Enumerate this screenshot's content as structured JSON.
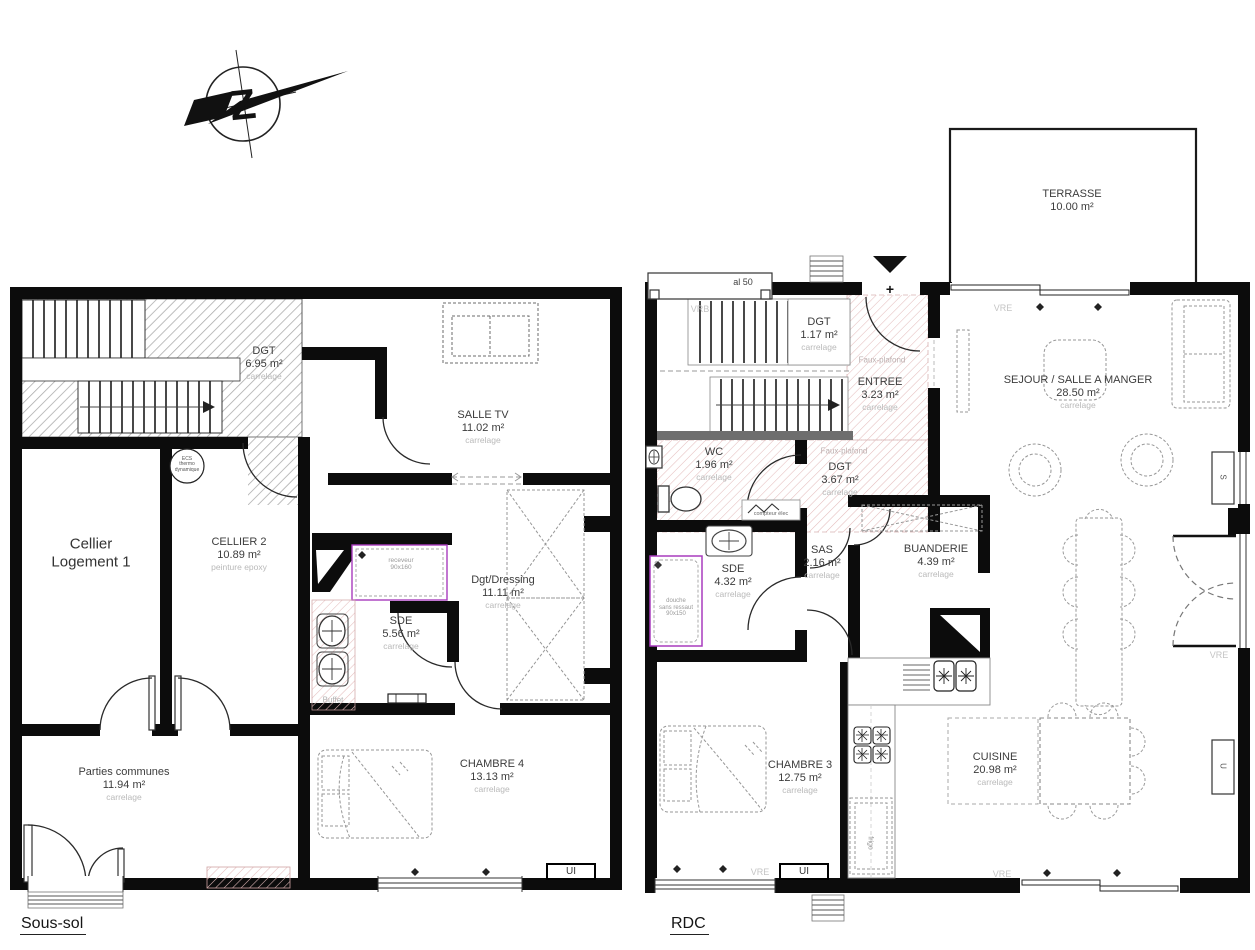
{
  "compass": {
    "letter": "Z"
  },
  "soussol": {
    "title": "Sous-sol",
    "rooms": {
      "dgt": {
        "name": "DGT",
        "area": "6.95 m²",
        "finish": "carrelage"
      },
      "salle_tv": {
        "name": "SALLE TV",
        "area": "11.02 m²",
        "finish": "carrelage"
      },
      "cellier": {
        "line1": "Cellier",
        "line2": "Logement 1"
      },
      "cellier2": {
        "name": "CELLIER 2",
        "area": "10.89 m²",
        "finish": "peinture epoxy"
      },
      "dgt_dressing": {
        "name": "Dgt/Dressing",
        "area": "11.11 m²",
        "finish": "carrelage"
      },
      "sde": {
        "name": "SDE",
        "area": "5.56 m²",
        "finish": "carrelage"
      },
      "parties": {
        "name": "Parties communes",
        "area": "11.94 m²",
        "finish": "carrelage"
      },
      "chambre4": {
        "name": "CHAMBRE 4",
        "area": "13.13 m²",
        "finish": "carrelage"
      }
    },
    "annotations": {
      "receveur_line1": "receveur",
      "receveur_line2": "90x160",
      "buffet": "Buffet",
      "ecs_line1": "ECS",
      "ecs_line2": "thermo",
      "ecs_line3": "dynamique",
      "ui": "UI"
    }
  },
  "rdc": {
    "title": "RDC",
    "rooms": {
      "terrasse": {
        "name": "TERRASSE",
        "area": "10.00 m²"
      },
      "dgt_haut": {
        "name": "DGT",
        "area": "1.17 m²",
        "finish": "carrelage"
      },
      "entree": {
        "name": "ENTREE",
        "area": "3.23 m²",
        "finish": "carrelage"
      },
      "wc": {
        "name": "WC",
        "area": "1.96 m²",
        "finish": "carrelage"
      },
      "dgt_bas": {
        "name": "DGT",
        "area": "3.67 m²",
        "finish": "carrelage"
      },
      "sejour": {
        "name": "SEJOUR / SALLE A MANGER",
        "area": "28.50 m²",
        "finish": "carrelage"
      },
      "sde": {
        "name": "SDE",
        "area": "4.32 m²",
        "finish": "carrelage"
      },
      "sas": {
        "name": "SAS",
        "area": "2.16 m²",
        "finish": "carrelage"
      },
      "buanderie": {
        "name": "BUANDERIE",
        "area": "4.39 m²",
        "finish": "carrelage"
      },
      "chambre3": {
        "name": "CHAMBRE 3",
        "area": "12.75 m²",
        "finish": "carrelage"
      },
      "cuisine": {
        "name": "CUISINE",
        "area": "20.98 m²",
        "finish": "carrelage"
      }
    },
    "annotations": {
      "faux_plafond": "Faux-plafond",
      "vrb": "VRB",
      "vre": "VRE",
      "al50": "al 50",
      "compteur": "compteur élec",
      "douche_line1": "douche",
      "douche_line2": "sans ressaut",
      "douche_line3": "90x150",
      "frigo": "frigo",
      "entrance_plus": "+",
      "s_marker": "S",
      "u_marker": "U",
      "ui": "UI"
    }
  }
}
